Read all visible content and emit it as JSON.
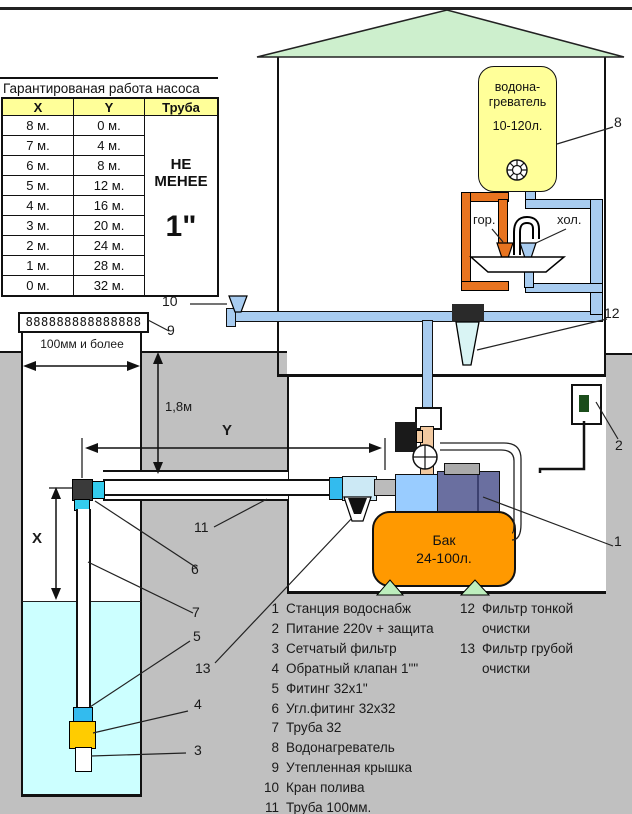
{
  "pump_table": {
    "title": "Гарантированая работа насоса",
    "headers": {
      "x": "X",
      "y": "Y",
      "pipe": "Труба"
    },
    "rows": [
      [
        "8 м.",
        "0 м."
      ],
      [
        "7 м.",
        "4 м."
      ],
      [
        "6 м.",
        "8 м."
      ],
      [
        "5 м.",
        "12 м."
      ],
      [
        "4 м.",
        "16 м."
      ],
      [
        "3 м.",
        "20 м."
      ],
      [
        "2 м.",
        "24 м."
      ],
      [
        "1 м.",
        "28 м."
      ],
      [
        "0 м.",
        "32 м."
      ]
    ],
    "pipe_note_line1": "НЕ",
    "pipe_note_line2": "МЕНЕЕ",
    "pipe_size": "1\""
  },
  "heater": {
    "name_line1": "водона-",
    "name_line2": "греватель",
    "capacity": "10-120л."
  },
  "sink": {
    "hot_label": "гор.",
    "cold_label": "хол."
  },
  "tank": {
    "name": "Бак",
    "capacity": "24-100л."
  },
  "dimensions": {
    "depth": "1,8м",
    "well_width": "100мм и более",
    "x": "X",
    "y": "Y"
  },
  "well_cover_pattern": "888888888888888",
  "callouts": {
    "c1": "1",
    "c2": "2",
    "c3": "3",
    "c4": "4",
    "c5": "5",
    "c6": "6",
    "c7": "7",
    "c8": "8",
    "c9": "9",
    "c10": "10",
    "c11": "11",
    "c12": "12",
    "c13": "13"
  },
  "legend": {
    "column1": [
      {
        "num": "1",
        "text": "Станция водоснабж"
      },
      {
        "num": "2",
        "text": "Питание 220v + защита"
      },
      {
        "num": "3",
        "text": "Сетчатый фильтр"
      },
      {
        "num": "4",
        "text": "Обратный клапан 1\"\""
      },
      {
        "num": "5",
        "text": "Фитинг 32х1\""
      },
      {
        "num": "6",
        "text": "Угл.фитинг 32х32"
      },
      {
        "num": "7",
        "text": "Труба 32"
      },
      {
        "num": "8",
        "text": "Водонагреватель"
      },
      {
        "num": "9",
        "text": "Утепленная крышка"
      },
      {
        "num": "10",
        "text": "Кран полива"
      },
      {
        "num": "11",
        "text": "Труба 100мм."
      }
    ],
    "column2": [
      {
        "num": "12",
        "text": "Фильтр тонкой"
      },
      {
        "num": "",
        "text": "очистки"
      },
      {
        "num": "13",
        "text": "Фильтр грубой"
      },
      {
        "num": "",
        "text": "очистки"
      }
    ]
  },
  "colors": {
    "ground": "#C0C0C0",
    "roof_green": "#CDEFCD",
    "heater_yellow": "#FFFF99",
    "tank_orange": "#FF9900",
    "pipe_blue": "#A8CCF0",
    "hot_orange": "#E87420",
    "water_cyan": "#CCFFFF",
    "fitting_cyan": "#33CCEE",
    "check_valve_yellow": "#FFCC00",
    "pump_blue": "#99CCFF",
    "motor_slate": "#6A6FA0",
    "riser_tan": "#F2C9A0"
  }
}
